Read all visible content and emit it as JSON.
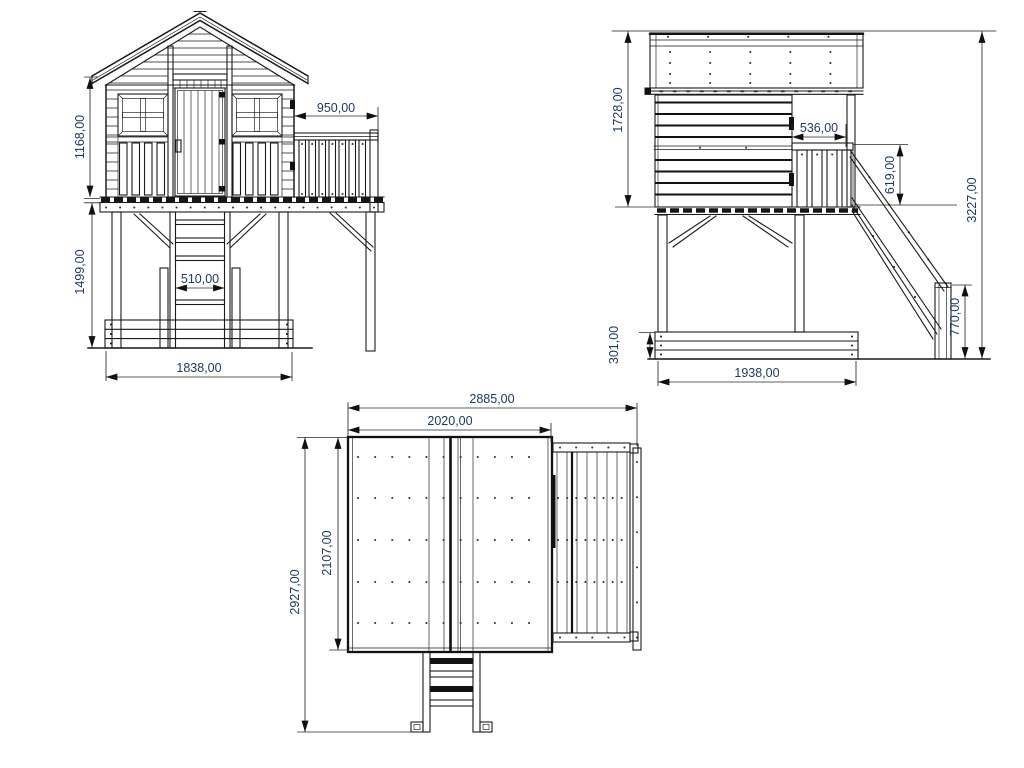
{
  "colors": {
    "line": "#1a1a1a",
    "dimension_text": "#1f3864",
    "background": "#ffffff"
  },
  "views": {
    "front": {
      "dimensions": {
        "wall_height": "1168,00",
        "support_height": "1499,00",
        "balcony_width": "950,00",
        "ladder_width": "510,00",
        "base_width": "1838,00"
      }
    },
    "side": {
      "dimensions": {
        "house_height": "1728,00",
        "balcony_depth": "536,00",
        "railing_height": "619,00",
        "total_height": "3227,00",
        "sandbox_height": "301,00",
        "slide_exit_height": "770,00",
        "base_depth": "1938,00"
      }
    },
    "top": {
      "dimensions": {
        "total_width": "2885,00",
        "roof_width": "2020,00",
        "roof_depth": "2107,00",
        "total_depth": "2927,00"
      }
    }
  }
}
